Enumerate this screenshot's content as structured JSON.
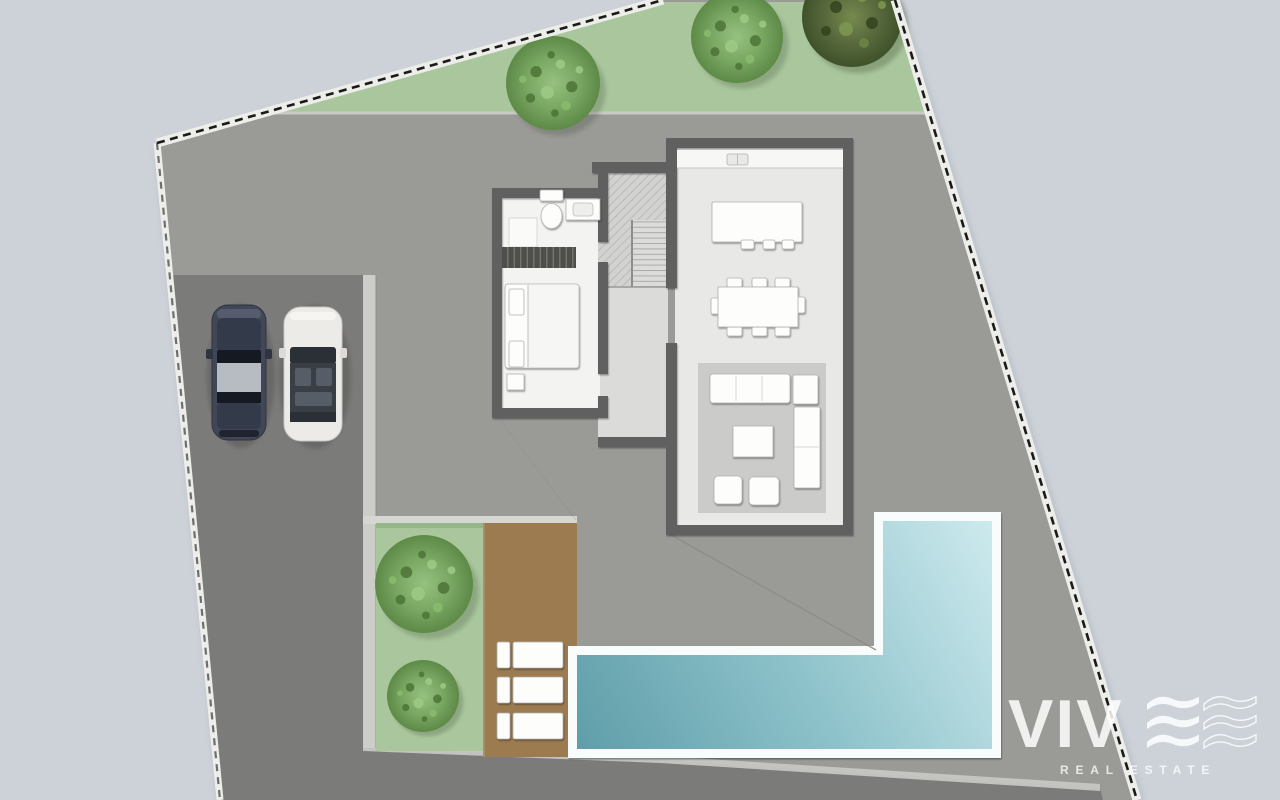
{
  "watermark": {
    "brand": "VIV",
    "brand_suffix_glyph": "stylized wavy E (solid) + outlined wavy E",
    "tagline": "REAL ESTATE",
    "color": "#ffffff"
  },
  "colors": {
    "background": "#cdd2d9",
    "plot": "#9a9a96",
    "driveway": "#7b7b79",
    "boundary_band": "#ededea",
    "boundary_dash": "#1a1a1a",
    "grass_strip": "#a9c69c",
    "garden_grass": "#a9c69c",
    "tree_light": "#79a863",
    "tree_dark": "#57693c",
    "deck_brown": "#9c7b51",
    "walkway_strip": "#cdcdc9",
    "curb": "#c6c6c2",
    "house_wall": "#606060",
    "floor_bedroom": "#f3f3f1",
    "floor_hall": "#dbdbd9",
    "floor_living": "#e8e8e6",
    "rug": "#cbcbc9",
    "furniture": "#fdfdfb",
    "pool_deck": "#f8fcfc",
    "pool_deep": "#5f9ea9",
    "pool_mid": "#8fc3cb",
    "pool_shallow": "#cdeaee",
    "car_dark_body": "#414757",
    "car_white_body": "#edebe7"
  },
  "scene": {
    "type": "villa site plan, top-down view",
    "trees_top_row": 3,
    "trees_garden": 2,
    "cars": 2,
    "sun_loungers": 3,
    "pool_shape": "L-shaped",
    "rooms": [
      "bathroom",
      "bedroom",
      "staircase hall",
      "kitchen",
      "dining area",
      "living area"
    ]
  }
}
